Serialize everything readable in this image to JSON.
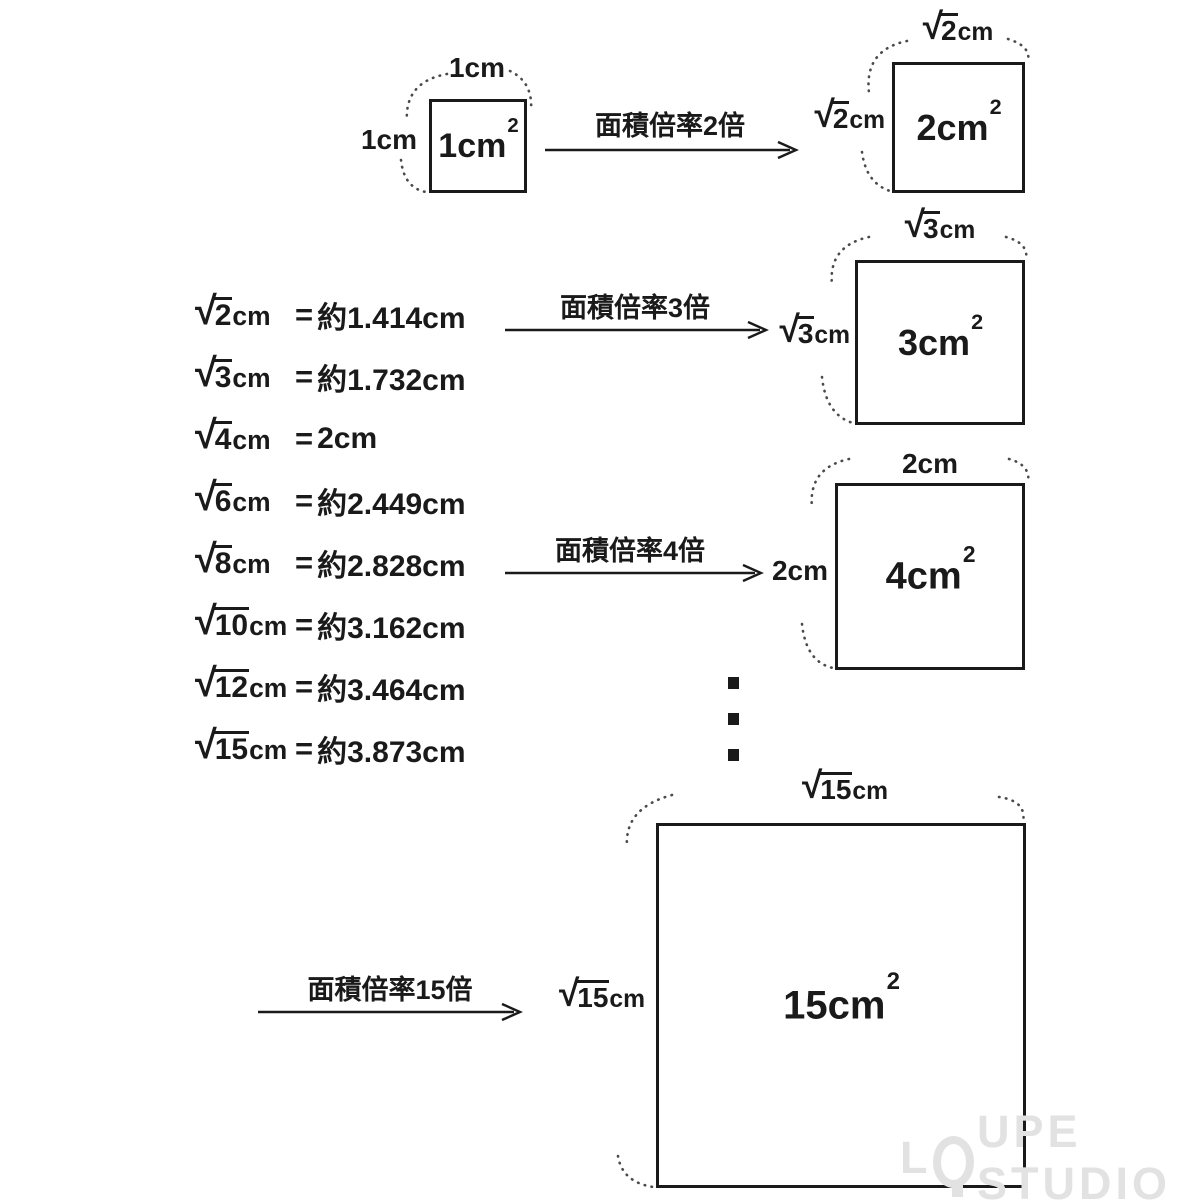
{
  "colors": {
    "ink": "#1a1a1a",
    "arc_dots": "#4a4a4a",
    "watermark": "#e2e2e2"
  },
  "sqrt_sign": "√",
  "list": {
    "items": [
      {
        "radicand": "2",
        "unit": "cm",
        "equals": "=",
        "value": "約1.414cm"
      },
      {
        "radicand": "3",
        "unit": "cm",
        "equals": "=",
        "value": "約1.732cm"
      },
      {
        "radicand": "4",
        "unit": "cm",
        "equals": "=",
        "value": "2cm"
      },
      {
        "radicand": "6",
        "unit": "cm",
        "equals": "=",
        "value": "約2.449cm"
      },
      {
        "radicand": "8",
        "unit": "cm",
        "equals": "=",
        "value": "約2.828cm"
      },
      {
        "radicand": "10",
        "unit": "cm",
        "equals": "=",
        "value": "約3.162cm"
      },
      {
        "radicand": "12",
        "unit": "cm",
        "equals": "=",
        "value": "約3.464cm"
      },
      {
        "radicand": "15",
        "unit": "cm",
        "equals": "=",
        "value": "約3.873cm"
      }
    ]
  },
  "arrows": [
    {
      "label": "面積倍率2倍"
    },
    {
      "label": "面積倍率3倍"
    },
    {
      "label": "面積倍率4倍"
    },
    {
      "label": "面積倍率15倍"
    }
  ],
  "squares": [
    {
      "area": "1cm",
      "sup": "2",
      "top_text": "1cm",
      "left_text": "1cm"
    },
    {
      "area": "2cm",
      "sup": "2",
      "top_radicand": "2",
      "top_unit": "cm",
      "left_radicand": "2",
      "left_unit": "cm"
    },
    {
      "area": "3cm",
      "sup": "2",
      "top_radicand": "3",
      "top_unit": "cm",
      "left_radicand": "3",
      "left_unit": "cm"
    },
    {
      "area": "4cm",
      "sup": "2",
      "top_text": "2cm",
      "left_text": "2cm"
    },
    {
      "area": "15cm",
      "sup": "2",
      "top_radicand": "15",
      "top_unit": "cm",
      "left_radicand": "15",
      "left_unit": "cm"
    }
  ],
  "ellipsis": {
    "icon": "vertical-ellipsis",
    "count": 3
  },
  "watermark": {
    "text": "LOUPE STUDIO",
    "prefix": "L",
    "suffix": "UPE STUDIO"
  }
}
